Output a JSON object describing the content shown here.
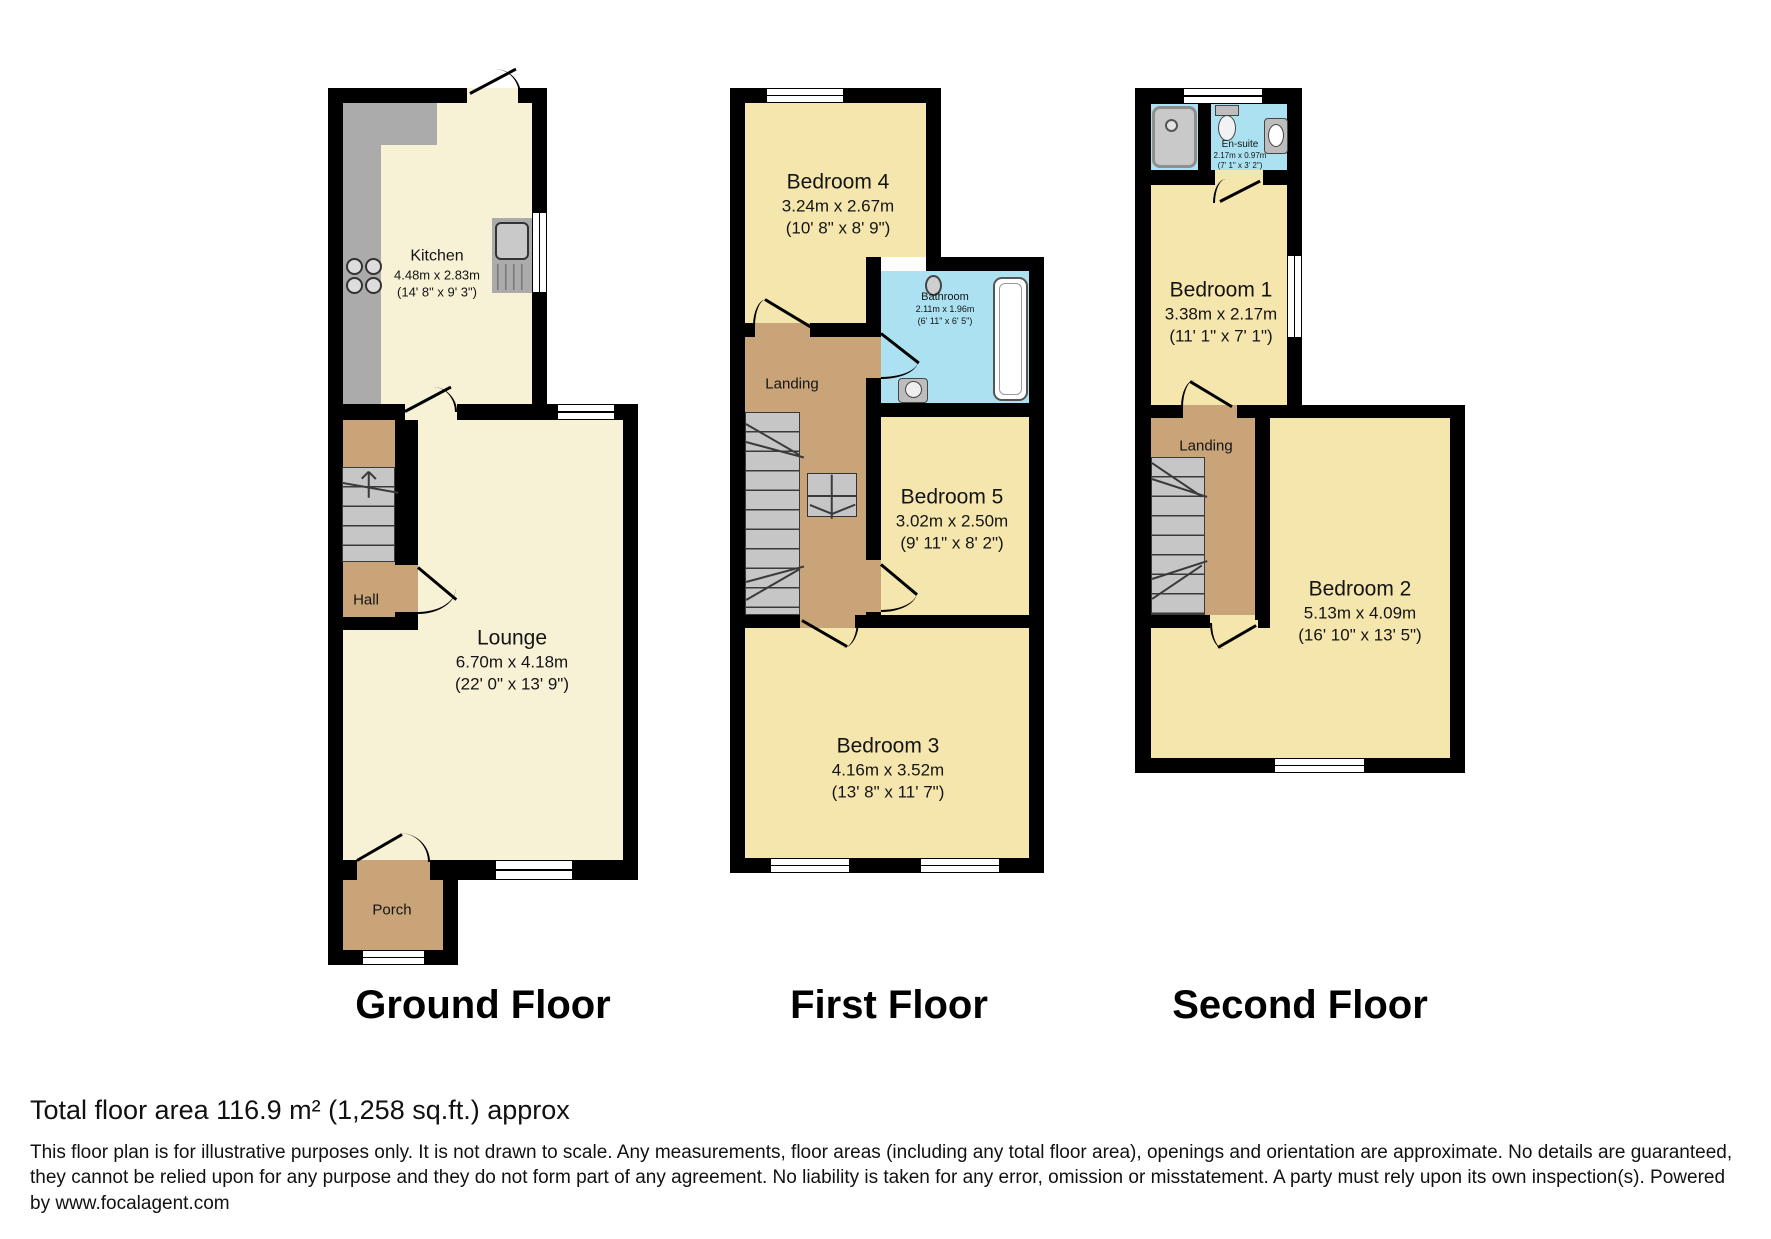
{
  "floors": [
    {
      "title": "Ground Floor",
      "rooms": [
        {
          "name": "Kitchen",
          "metric": "4.48m x 2.83m",
          "imperial": "(14' 8\" x 9' 3\")"
        },
        {
          "name": "Hall"
        },
        {
          "name": "Lounge",
          "metric": "6.70m x 4.18m",
          "imperial": "(22' 0\" x 13' 9\")"
        },
        {
          "name": "Porch"
        }
      ]
    },
    {
      "title": "First Floor",
      "rooms": [
        {
          "name": "Bedroom 4",
          "metric": "3.24m x 2.67m",
          "imperial": "(10' 8\" x 8' 9\")"
        },
        {
          "name": "Bathroom",
          "metric": "2.11m x 1.96m",
          "imperial": "(6' 11\" x 6' 5\")"
        },
        {
          "name": "Landing"
        },
        {
          "name": "Bedroom 5",
          "metric": "3.02m x 2.50m",
          "imperial": "(9' 11\" x 8' 2\")"
        },
        {
          "name": "Bedroom 3",
          "metric": "4.16m x 3.52m",
          "imperial": "(13' 8\" x 11' 7\")"
        }
      ]
    },
    {
      "title": "Second Floor",
      "rooms": [
        {
          "name": "En-suite",
          "metric": "2.17m x 0.97m",
          "imperial": "(7' 1\" x 3' 2\")"
        },
        {
          "name": "Bedroom 1",
          "metric": "3.38m x 2.17m",
          "imperial": "(11' 1\" x 7' 1\")"
        },
        {
          "name": "Landing"
        },
        {
          "name": "Bedroom 2",
          "metric": "5.13m x 4.09m",
          "imperial": "(16' 10\" x 13' 5\")"
        }
      ]
    }
  ],
  "footer": {
    "total_area": "Total floor area 116.9 m² (1,258 sq.ft.) approx",
    "disclaimer": "This floor plan is for illustrative purposes only. It is not drawn to scale. Any measurements, floor areas (including any total floor area), openings and orientation are approximate. No details are guaranteed, they cannot be relied upon for any purpose and they do not form part of any agreement. No liability is taken for any error, omission or misstatement. A party must rely upon its own inspection(s). Powered by www.focalagent.com"
  },
  "colors": {
    "wall": "#000000",
    "cream": "#F7F1D6",
    "bedroom": "#F5E6AE",
    "tan": "#C9A478",
    "bath": "#ABE1F1",
    "counter": "#ABABAB",
    "stairs": "#C6C6C6"
  }
}
